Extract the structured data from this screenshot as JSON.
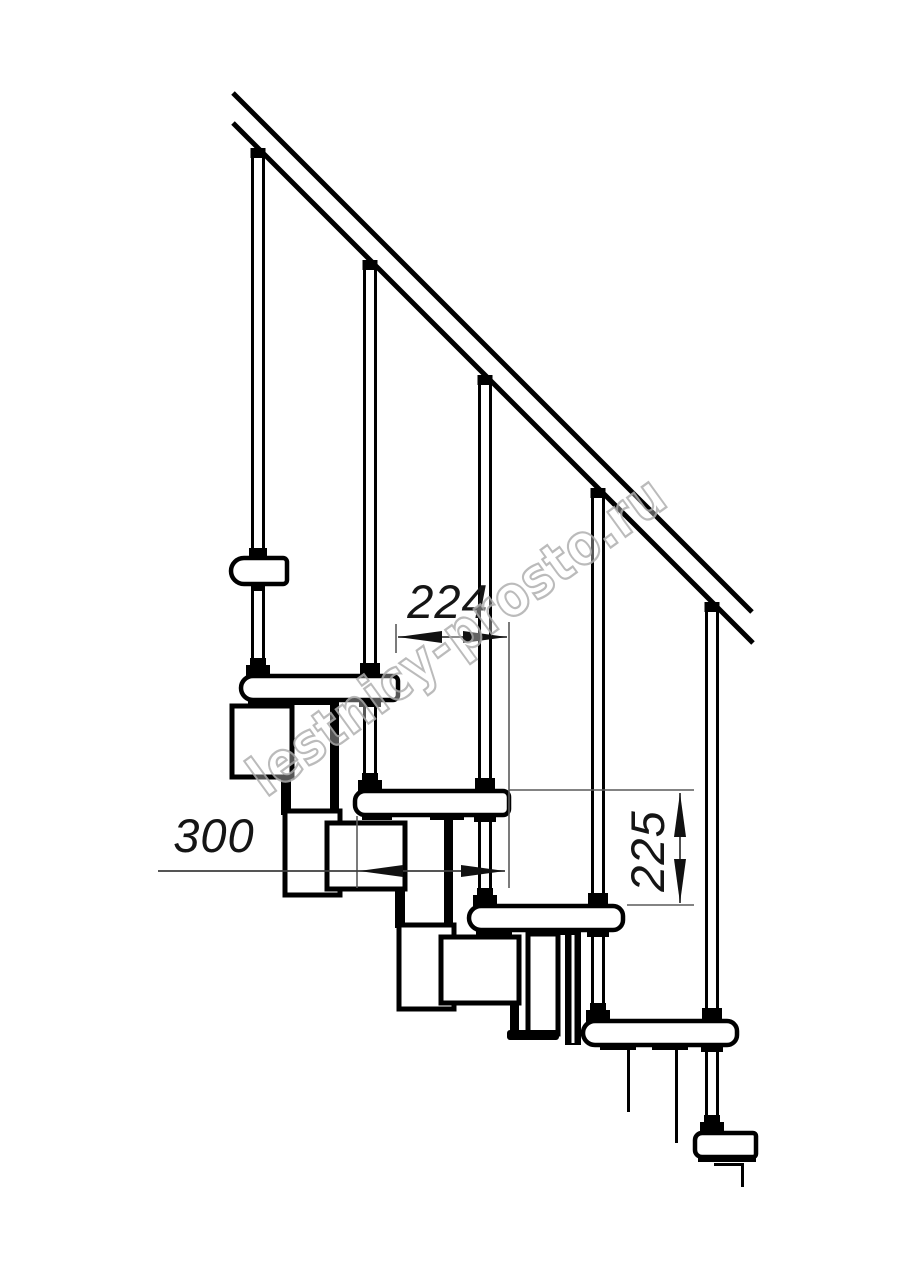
{
  "drawing": {
    "watermark": "lestnicy-prosto.ru",
    "dimensions": [
      {
        "id": "going",
        "value": "224",
        "orientation": "horizontal"
      },
      {
        "id": "tread-length",
        "value": "300",
        "orientation": "horizontal"
      },
      {
        "id": "rise",
        "value": "225",
        "orientation": "vertical"
      }
    ],
    "colors": {
      "line": "#000000",
      "background": "#ffffff",
      "watermark_outline": "#b0b0b0",
      "dimension_text": "#151515"
    },
    "counts": {
      "balusters": 5,
      "treads": 6
    }
  }
}
